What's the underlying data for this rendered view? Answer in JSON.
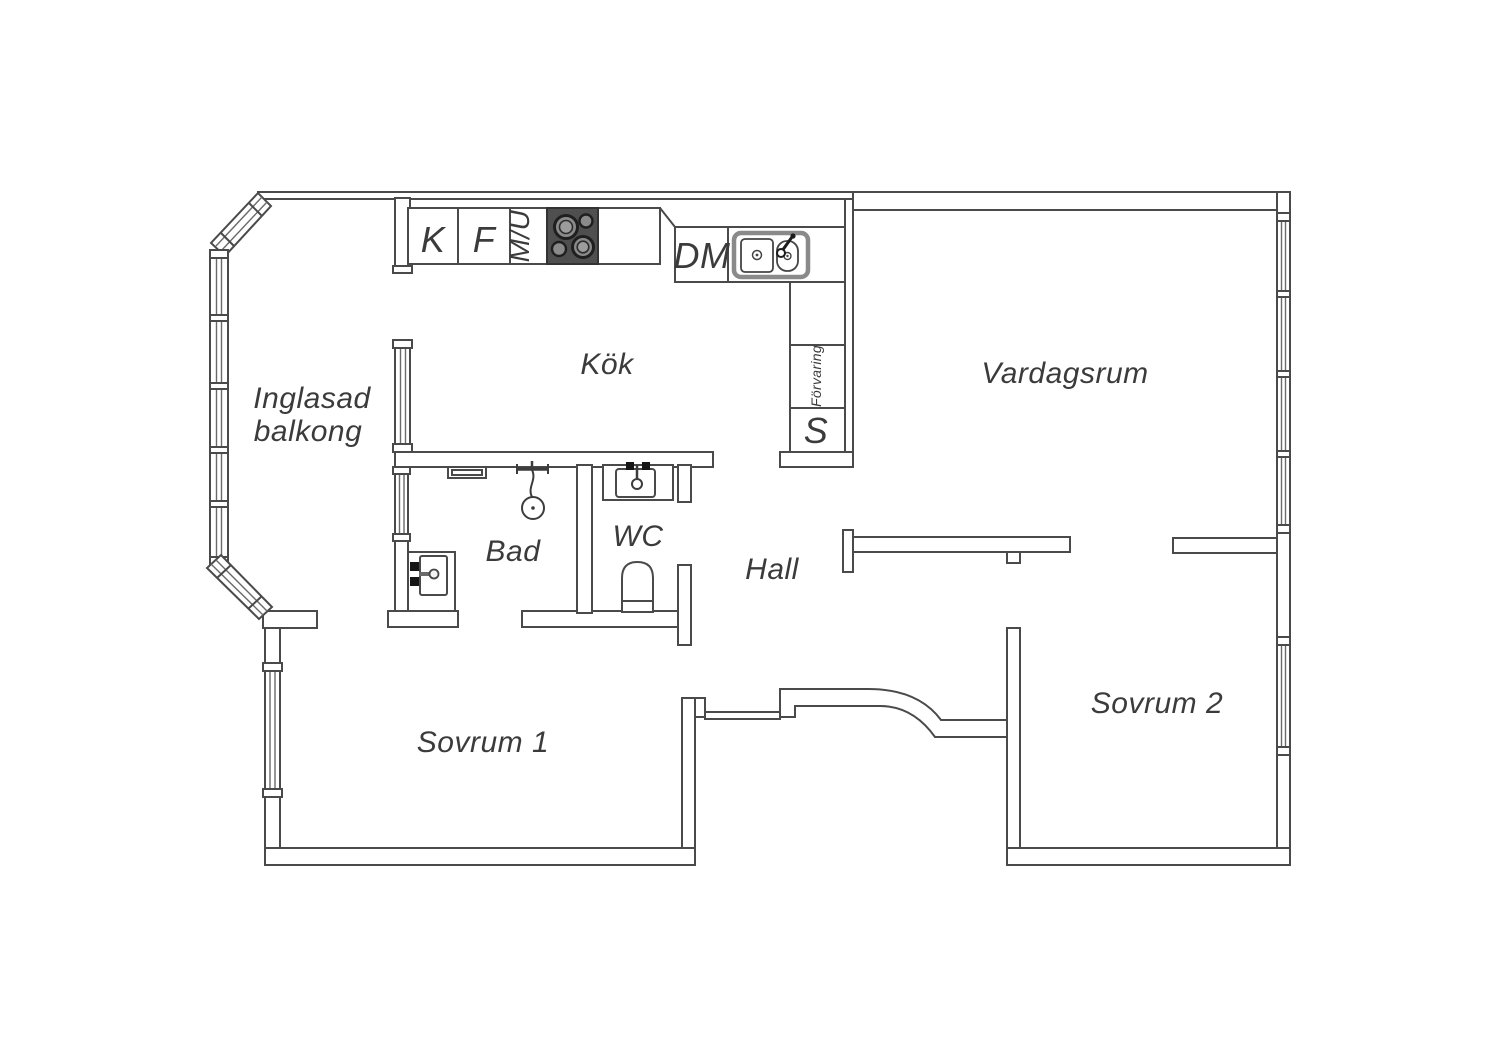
{
  "floorplan": {
    "rooms": {
      "balcony_line1": "Inglasad",
      "balcony_line2": "balkong",
      "kitchen": "Kök",
      "living_room": "Vardagsrum",
      "bathroom": "Bad",
      "wc": "WC",
      "hall": "Hall",
      "bedroom1": "Sovrum 1",
      "bedroom2": "Sovrum 2"
    },
    "kitchen_units": {
      "fridge": "K",
      "freezer": "F",
      "micro_oven": "M/U",
      "dishwasher": "DM",
      "storage": "Förvaring",
      "cabinet": "S"
    },
    "colors": {
      "line": "#4a4a4a",
      "text": "#3b3b3b",
      "stove_fill": "#4f4f4f",
      "background": "#ffffff"
    }
  }
}
